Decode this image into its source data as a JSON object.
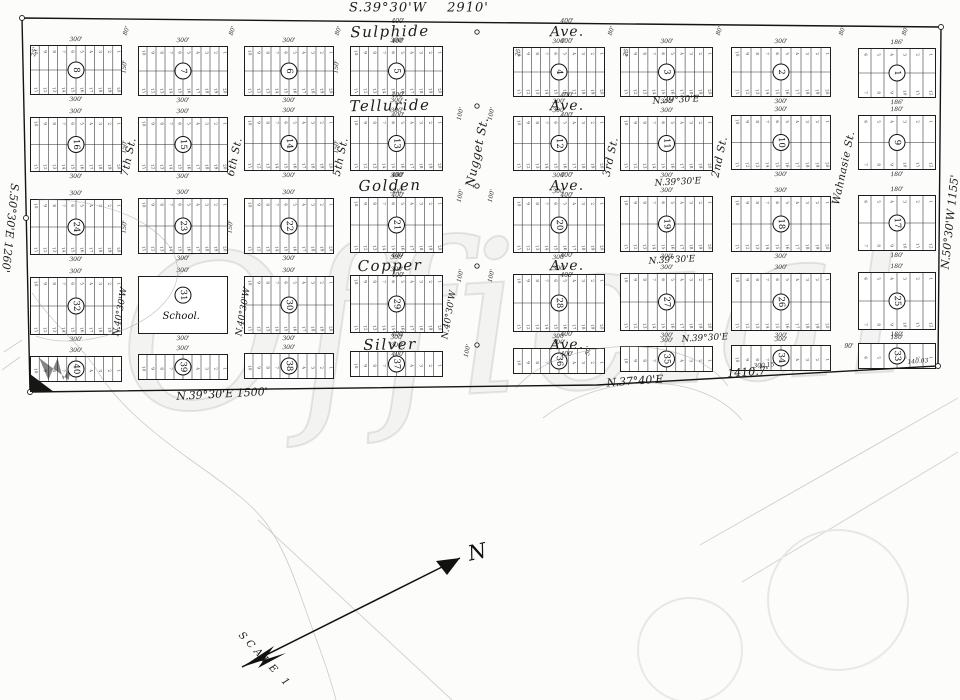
{
  "watermark": "Official",
  "north_label": "N",
  "scale_label": "SCALE 1",
  "boundary": {
    "top": {
      "bearing": "S.39°30'W",
      "distance": "2910'"
    },
    "left": {
      "bearing": "S.50°30'E",
      "distance": "1260'"
    },
    "right": {
      "bearing": "N.50°30'W",
      "distance": "1155'"
    },
    "bottom_left": {
      "bearing": "N.39°30'E",
      "distance": "1500'"
    },
    "bottom_right": {
      "bearing": "N.37°40'E",
      "distance": "1410.7'"
    }
  },
  "avenues": [
    {
      "name": "Sulphide",
      "suffix": "Ave.",
      "y": 32
    },
    {
      "name": "Telluride",
      "suffix": "Ave.",
      "y": 106
    },
    {
      "name": "Golden",
      "suffix": "Ave.",
      "y": 186
    },
    {
      "name": "Copper",
      "suffix": "Ave.",
      "y": 266
    },
    {
      "name": "Silver",
      "suffix": "Ave.",
      "y": 345
    }
  ],
  "cross_streets": [
    {
      "name": "7th St.",
      "x": 129,
      "y": 157
    },
    {
      "name": "6th St.",
      "x": 235,
      "y": 157
    },
    {
      "name": "5th St.",
      "x": 341,
      "y": 157
    },
    {
      "name": "Nugget St.",
      "x": 477,
      "y": 152
    },
    {
      "name": "3rd St.",
      "x": 611,
      "y": 157
    },
    {
      "name": "2nd St.",
      "x": 720,
      "y": 157
    },
    {
      "name": "Wahnasie St.",
      "x": 844,
      "y": 168
    }
  ],
  "blocks": {
    "rows": [
      [
        8,
        7,
        6,
        5,
        4,
        3,
        2,
        1
      ],
      [
        16,
        15,
        14,
        13,
        12,
        11,
        10,
        9
      ],
      [
        24,
        23,
        22,
        21,
        20,
        19,
        18,
        17
      ],
      [
        32,
        31,
        30,
        29,
        28,
        27,
        26,
        25
      ],
      [
        40,
        39,
        38,
        37,
        36,
        35,
        34,
        33
      ]
    ],
    "school_block": 31,
    "school_label": "School.",
    "standard_width_label": "300'",
    "narrow_width_label_first_row": "186'",
    "narrow_width_label": "180'",
    "avenue_width_label": "400'",
    "lots_per_tier": 10,
    "narrow_lots_per_tier": 6
  },
  "interior_bearings": [
    {
      "text": "N.39°30'E",
      "x": 676,
      "y": 101,
      "rot": -3
    },
    {
      "text": "N.39°30'E",
      "x": 678,
      "y": 183,
      "rot": -3
    },
    {
      "text": "N.39°30'E",
      "x": 672,
      "y": 261,
      "rot": -3
    },
    {
      "text": "N.39°30'E",
      "x": 705,
      "y": 339,
      "rot": -3
    },
    {
      "text": "N.40°30'W",
      "x": 121,
      "y": 312,
      "rot": -80
    },
    {
      "text": "N.40°30'W",
      "x": 244,
      "y": 312,
      "rot": -80
    },
    {
      "text": "N.40°30'W",
      "x": 450,
      "y": 315,
      "rot": -80
    }
  ],
  "dim_labels": [
    {
      "text": "80'",
      "x": 127,
      "y": 31,
      "rot": -72
    },
    {
      "text": "80'",
      "x": 233,
      "y": 31,
      "rot": -72
    },
    {
      "text": "80'",
      "x": 339,
      "y": 31,
      "rot": -72
    },
    {
      "text": "80'",
      "x": 612,
      "y": 31,
      "rot": -72
    },
    {
      "text": "80'",
      "x": 720,
      "y": 31,
      "rot": -72
    },
    {
      "text": "80'",
      "x": 843,
      "y": 31,
      "rot": -72
    },
    {
      "text": "80'",
      "x": 906,
      "y": 31,
      "rot": -72
    },
    {
      "text": "100'",
      "x": 461,
      "y": 114,
      "rot": -78
    },
    {
      "text": "100'",
      "x": 492,
      "y": 114,
      "rot": -78
    },
    {
      "text": "100'",
      "x": 461,
      "y": 196,
      "rot": -78
    },
    {
      "text": "100'",
      "x": 492,
      "y": 196,
      "rot": -78
    },
    {
      "text": "100'",
      "x": 461,
      "y": 276,
      "rot": -78
    },
    {
      "text": "100'",
      "x": 492,
      "y": 276,
      "rot": -78
    },
    {
      "text": "100'",
      "x": 468,
      "y": 351,
      "rot": -78
    },
    {
      "text": "150'",
      "x": 125,
      "y": 67,
      "rot": -84
    },
    {
      "text": "150'",
      "x": 337,
      "y": 67,
      "rot": -84
    },
    {
      "text": "150'",
      "x": 125,
      "y": 147,
      "rot": -84
    },
    {
      "text": "150'",
      "x": 337,
      "y": 147,
      "rot": -84
    },
    {
      "text": "150'",
      "x": 125,
      "y": 227,
      "rot": -84
    },
    {
      "text": "150'",
      "x": 231,
      "y": 227,
      "rot": -84
    },
    {
      "text": "25'",
      "x": 35,
      "y": 52,
      "rot": -78
    },
    {
      "text": "25'",
      "x": 519,
      "y": 52,
      "rot": -78
    },
    {
      "text": "25'",
      "x": 627,
      "y": 52,
      "rot": -78
    },
    {
      "text": "50'",
      "x": 589,
      "y": 351,
      "rot": -78
    },
    {
      "text": "90'",
      "x": 849,
      "y": 347,
      "rot": 0
    },
    {
      "text": "300.15",
      "x": 764,
      "y": 366,
      "rot": -4
    },
    {
      "text": "140.03",
      "x": 918,
      "y": 362,
      "rot": -4
    }
  ]
}
